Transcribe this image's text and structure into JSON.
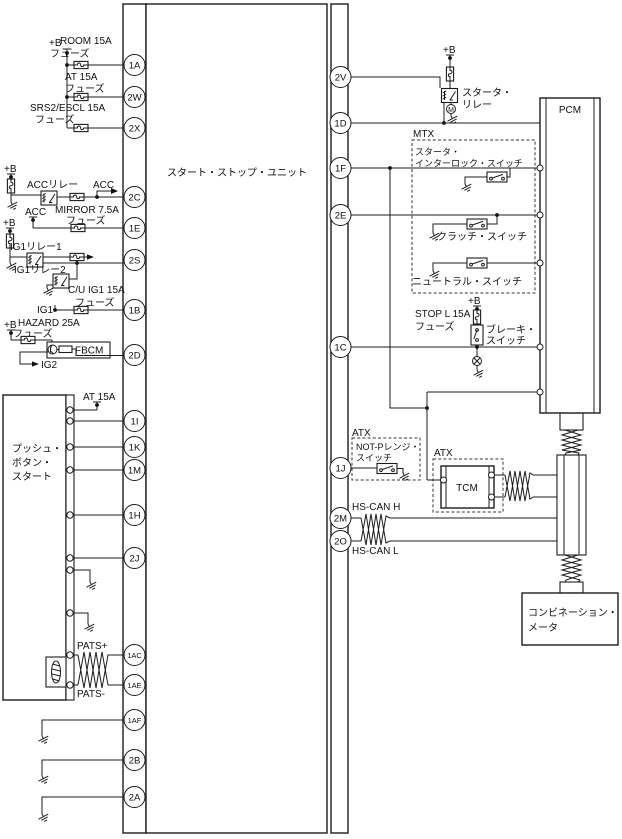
{
  "diagram": {
    "unit_label": "スタート・ストップ・ユニット",
    "pbs_label_1": "プッシュ・",
    "pbs_label_2": "ボタン・",
    "pbs_label_3": "スタート",
    "pcm": "PCM",
    "tcm": "TCM",
    "fbcm": "FBCM",
    "mtx": "MTX",
    "atx": "ATX",
    "meter_1": "コンビネーション・",
    "meter_2": "メータ",
    "motor": "M"
  },
  "power": {
    "plus_b": "+B",
    "acc": "ACC",
    "ig1": "IG1",
    "ig2": "IG2"
  },
  "fuses": {
    "word": "フューズ",
    "room": "ROOM 15A",
    "at": "AT 15A",
    "srs2": "SRS2/ESCL 15A",
    "mirror": "MIRROR 7.5A",
    "cu_ig1": "C/U IG1 15A",
    "hazard": "HAZARD 25A",
    "at_pbs": "AT 15A",
    "stop_l": "STOP L 15A"
  },
  "relays": {
    "acc": "ACCリレー",
    "ig1_1": "IG1リレー1",
    "ig1_2": "IG1リレー2",
    "starter_1": "スタータ・",
    "starter_2": "リレー"
  },
  "switches": {
    "interlock_1": "スタータ・",
    "interlock_2": "インターロック・スイッチ",
    "clutch": "クラッチ・スイッチ",
    "neutral": "ニュートラル・スイッチ",
    "brake_1": "ブレーキ・",
    "brake_2": "スイッチ",
    "notp_1": "NOT-Pレンジ・",
    "notp_2": "スイッチ"
  },
  "signals": {
    "pats_plus": "PATS+",
    "pats_minus": "PATS-",
    "hs_can_h": "HS-CAN H",
    "hs_can_l": "HS-CAN L"
  },
  "connectors": {
    "left": [
      "1A",
      "2W",
      "2X",
      "2C",
      "1E",
      "2S",
      "1B",
      "2D",
      "1I",
      "1K",
      "1M",
      "1H",
      "2J",
      "1AC",
      "1AE",
      "1AF",
      "2B",
      "2A"
    ],
    "right": [
      "2V",
      "1D",
      "1F",
      "2E",
      "1C",
      "1J",
      "2M",
      "2O"
    ]
  }
}
